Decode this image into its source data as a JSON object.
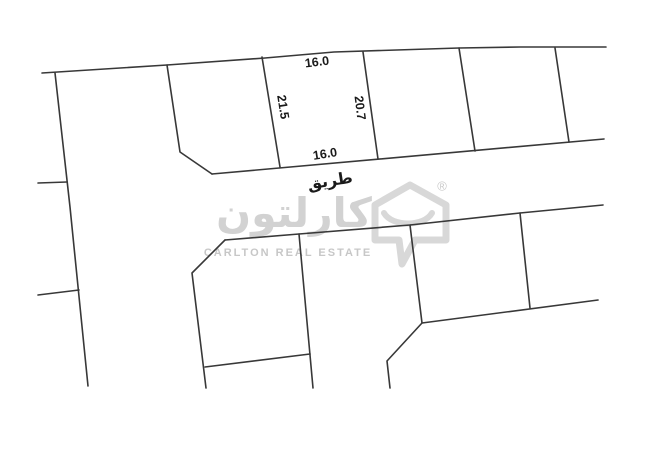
{
  "map": {
    "road_label": "طريق",
    "dimensions": {
      "top": "16.0",
      "left": "21.5",
      "right": "20.7",
      "bottom": "16.0"
    },
    "lines": {
      "top_boundary": "42,73 167,65 265,58 334,52 459,48 520,47 606,47",
      "left_road_edge": "55,73 70,207 88,386",
      "left_stub_upper": "38,183 67,182",
      "left_stub_lower": "38,295 79,290",
      "top_row_divider_1": "167,65 180,152 212,174",
      "top_row_divider_2": "262,57 280,167",
      "top_row_divider_3": "363,52 378,159",
      "top_row_divider_4": "459,48 475,151",
      "top_row_divider_5": "555,48 569,142",
      "top_row_bottom": "212,174 604,139",
      "mid_block_top": "225,240 299,234 410,225 520,213 603,205",
      "mid_plot_left": "225,240 192,273 206,388",
      "mid_plot_right": "299,234 313,388",
      "mid_plot_bottom": "205,367 310,354",
      "right_block_left": "410,225 422,323 387,361 390,388",
      "right_block_divider": "520,213 530,308",
      "right_block_bottom": "422,323 598,300"
    }
  },
  "watermark": {
    "arabic_name": "كارلتون",
    "english_name": "CARLTON REAL ESTATE",
    "registered_mark": "®"
  },
  "colors": {
    "background": "#ffffff",
    "plot_line": "#383838",
    "dimension_text": "#1a1a1a",
    "watermark_gray": "#d2d2d2",
    "watermark_english_gray": "#c7c7c7"
  }
}
